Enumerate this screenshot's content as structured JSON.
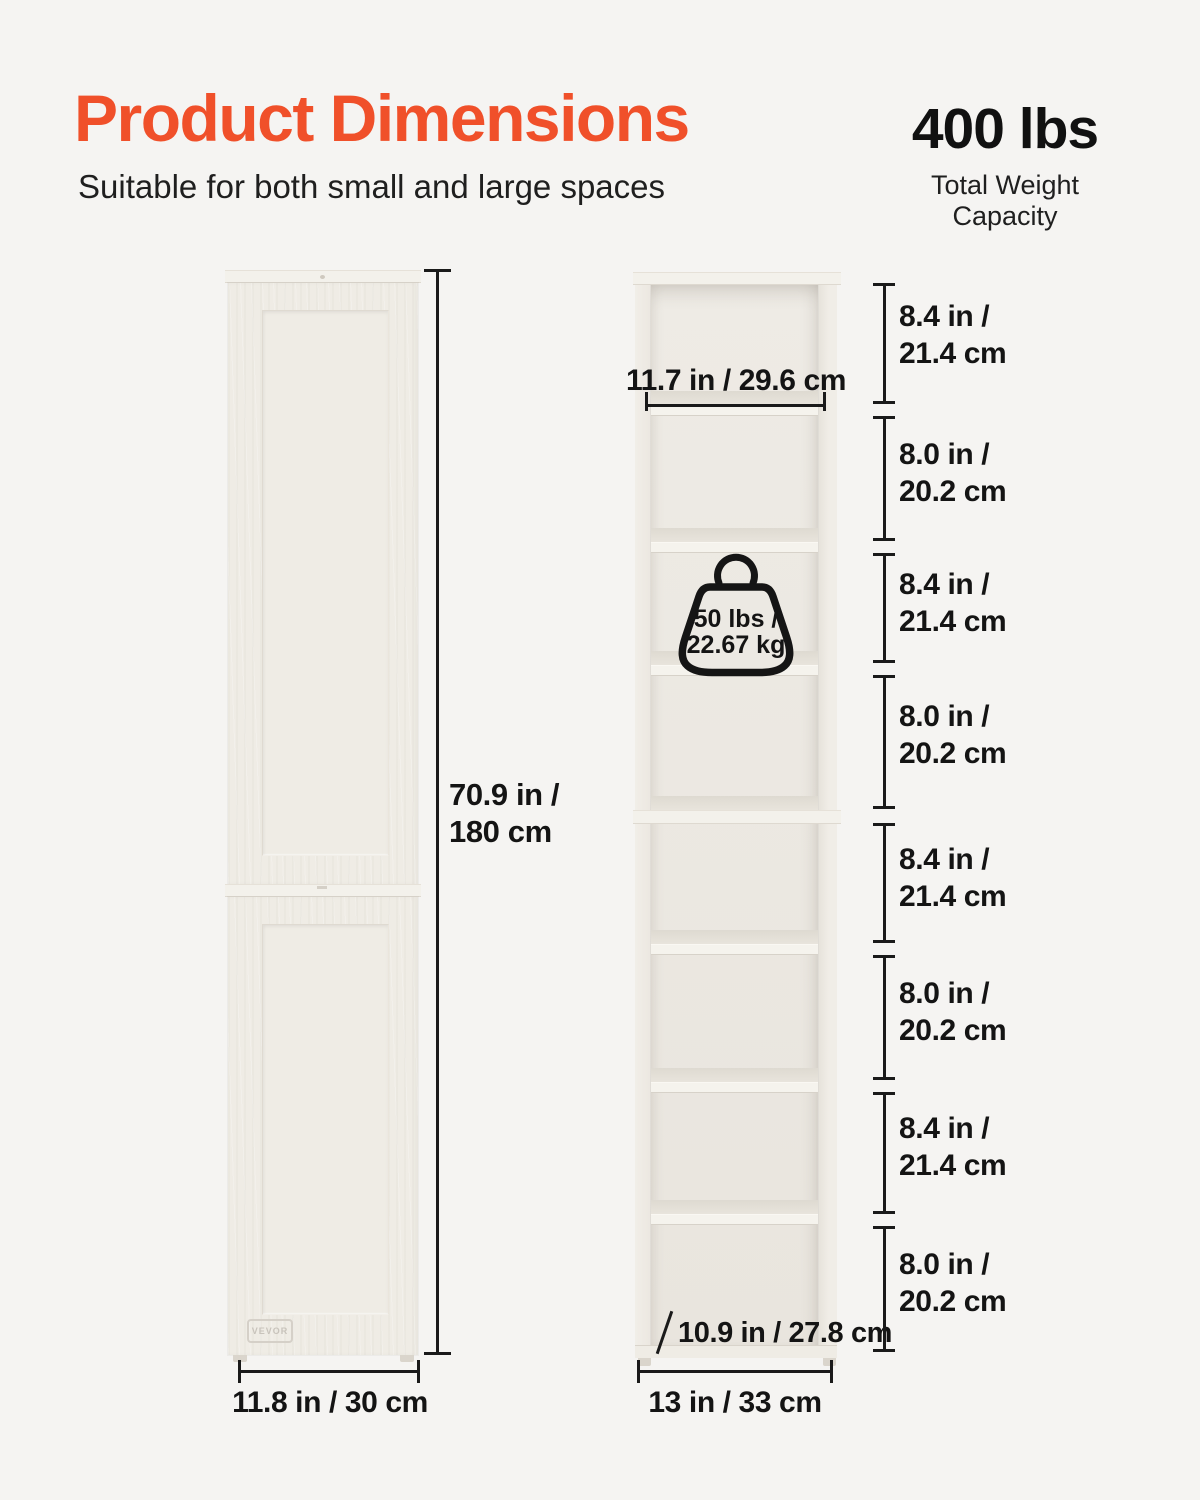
{
  "header": {
    "title": "Product Dimensions",
    "subtitle": "Suitable for both small and large spaces",
    "capacity_value": "400 lbs",
    "capacity_label": "Total Weight Capacity"
  },
  "cabinet": {
    "brand": "VEVOR"
  },
  "dimensions": {
    "overall_height": "70.9 in /\n180 cm",
    "cabinet_width": "11.8 in / 30 cm",
    "shelf_inner_width": "11.7 in / 29.6 cm",
    "shelf_depth": "10.9 in / 27.8 cm",
    "base_width": "13 in / 33 cm",
    "per_shelf_capacity": "50 lbs /\n22.67 kg",
    "compartments": [
      "8.4 in /\n21.4 cm",
      "8.0 in /\n20.2 cm",
      "8.4 in /\n21.4 cm",
      "8.0 in /\n20.2 cm",
      "8.4 in /\n21.4 cm",
      "8.0 in /\n20.2 cm",
      "8.4 in /\n21.4 cm",
      "8.0 in /\n20.2 cm"
    ]
  },
  "colors": {
    "accent": "#F0502A",
    "text": "#161616",
    "background": "#F5F4F2",
    "cabinet_face": "#EFECE5"
  }
}
